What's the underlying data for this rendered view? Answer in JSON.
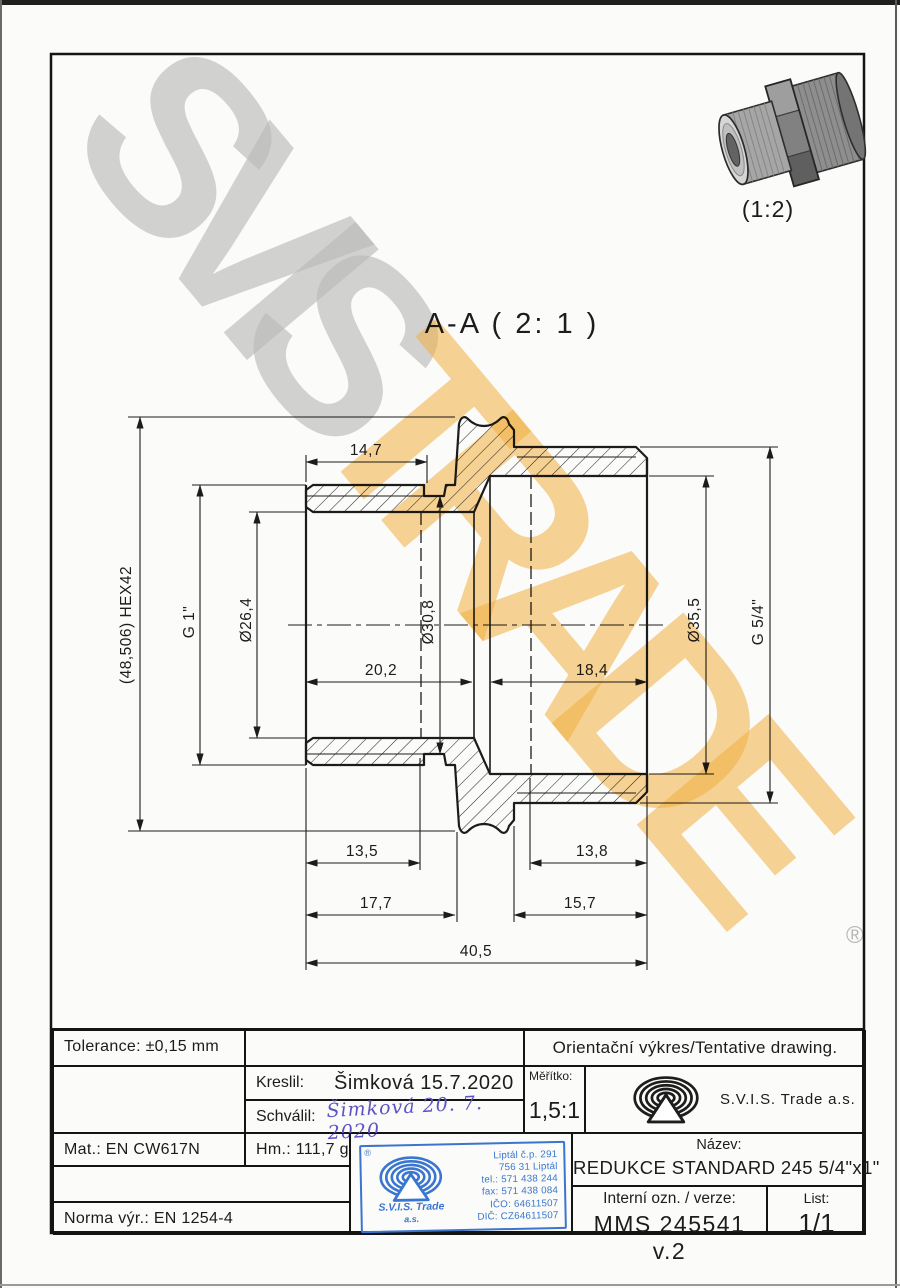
{
  "page": {
    "section_title": "A-A ( 2: 1 )",
    "thumb_scale": "(1:2)",
    "registered_mark": "®"
  },
  "watermark": {
    "word1": "SVIS",
    "word2": "TRADE"
  },
  "colors": {
    "watermark_gray": "#bbbbbb",
    "watermark_orange": "#f4b242",
    "stamp_blue": "#3a76cf",
    "signature_ink": "#5d54c4",
    "line": "#1c1c1c"
  },
  "dimensions": {
    "len_14_7": "14,7",
    "len_20_2": "20,2",
    "len_18_4": "18,4",
    "len_13_5": "13,5",
    "len_13_8": "13,8",
    "len_17_7": "17,7",
    "len_15_7": "15,7",
    "len_40_5": "40,5",
    "hex": "(48,506) HEX42",
    "g1": "G 1\"",
    "dia_26_4": "Ø26,4",
    "dia_30_8": "Ø30,8",
    "dia_35_5": "Ø35,5",
    "g54": "G 5/4\""
  },
  "title_block": {
    "tolerance": "Tolerance: ±0,15 mm",
    "orientation_note": "Orientační výkres/Tentative drawing.",
    "kreslil_label": "Kreslil:",
    "kreslil_value": "Šimková 15.7.2020",
    "schvalil_label": "Schválil:",
    "schvalil_signature": "Šimková 20. 7. 2020",
    "meritko_label": "Měřítko:",
    "meritko_value": "1,5:1",
    "company": "S.V.I.S. Trade a.s.",
    "mat": "Mat.: EN CW617N",
    "hm": "Hm.: 111,7 g",
    "norma": "Norma výr.: EN 1254-4",
    "nazev_label": "Název:",
    "nazev_value": "REDUKCE STANDARD 245 5/4\"x1\"",
    "interni_label": "Interní ozn. / verze:",
    "interni_value": "MMS 245541 v.2",
    "list_label": "List:",
    "list_value": "1/1"
  },
  "stamp": {
    "registered": "®",
    "company": "S.V.I.S. Trade",
    "company_suffix": "a.s.",
    "lines": [
      "Liptál č.p. 291",
      "756 31 Liptál",
      "tel.: 571 438 244",
      "fax: 571 438 084",
      "IČO: 64611507",
      "DIČ: CZ64611507"
    ]
  }
}
